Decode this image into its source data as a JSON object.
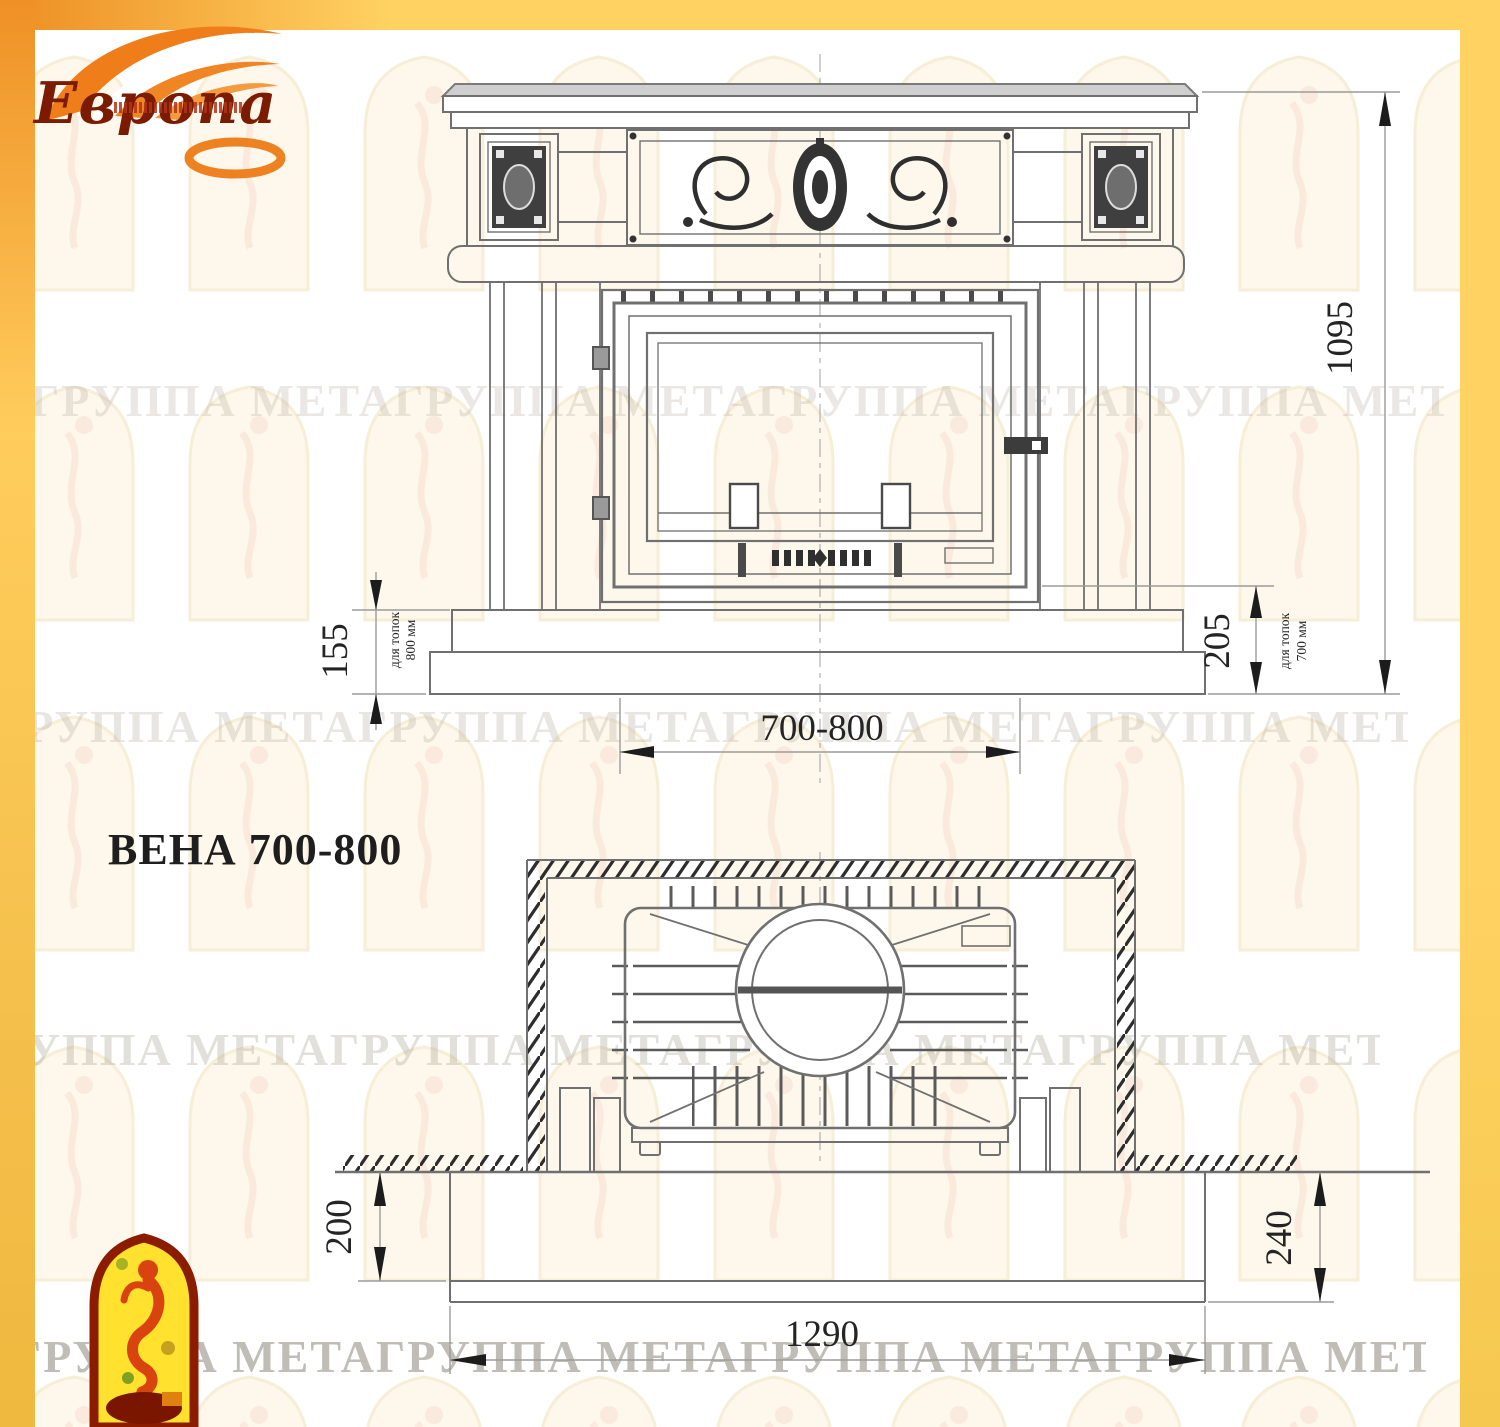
{
  "logo": {
    "brand": "Европа",
    "brand_color": "#7B1B02",
    "flame_color": "#EF8220"
  },
  "title": "ВЕНА 700-800",
  "watermark_text": "ГРУППА МЕТАГРУППА МЕТАГРУППА МЕТАГРУППА МЕТАГРУППА МЕТА",
  "front_view": {
    "dim_total_height": "1095",
    "dim_hearth_height_left": "155",
    "dim_hearth_height_right": "205",
    "dim_opening_width": "700-800",
    "note_left_line1": "для топок",
    "note_left_line2": "800 мм",
    "note_right_line1": "для топок",
    "note_right_line2": "700 мм"
  },
  "plan_view": {
    "dim_depth_front": "200",
    "dim_depth_total": "240",
    "dim_hearth_width": "1290"
  },
  "colors": {
    "border_yellow": "#FFD262",
    "border_orange": "#ED8D22",
    "line_gray": "#707070",
    "dim_text": "#242424"
  }
}
